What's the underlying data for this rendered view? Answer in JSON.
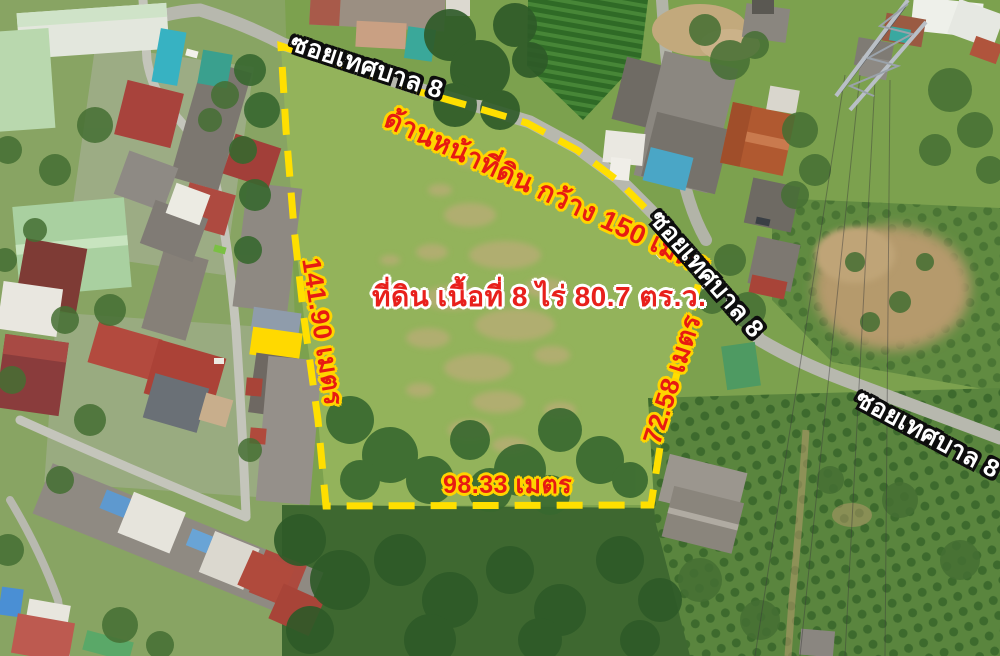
{
  "roads": {
    "top": "ซอยเทศบาล 8",
    "right": "ซอยเทศบาล 8",
    "bottom_right": "ซอยเทศบาล 8"
  },
  "plot": {
    "area_label": "ที่ดิน เนื้อที่ 8 ไร่ 80.7 ตร.ว.",
    "frontage_label": "ด้านหน้าที่ดิน กว้าง 150 เมตร",
    "side_left": "141.90 เมตร",
    "side_right": "72.58 เมตร",
    "side_bottom": "98.33 เมตร"
  },
  "colors": {
    "boundary": "#ffdf00",
    "measure_text": "#e71a12",
    "measure_outline": "#ffd400",
    "road_text": "#ffffff",
    "road_outline": "#0d0d0d",
    "area_text": "#e8201c",
    "area_outline": "#ffffff"
  }
}
